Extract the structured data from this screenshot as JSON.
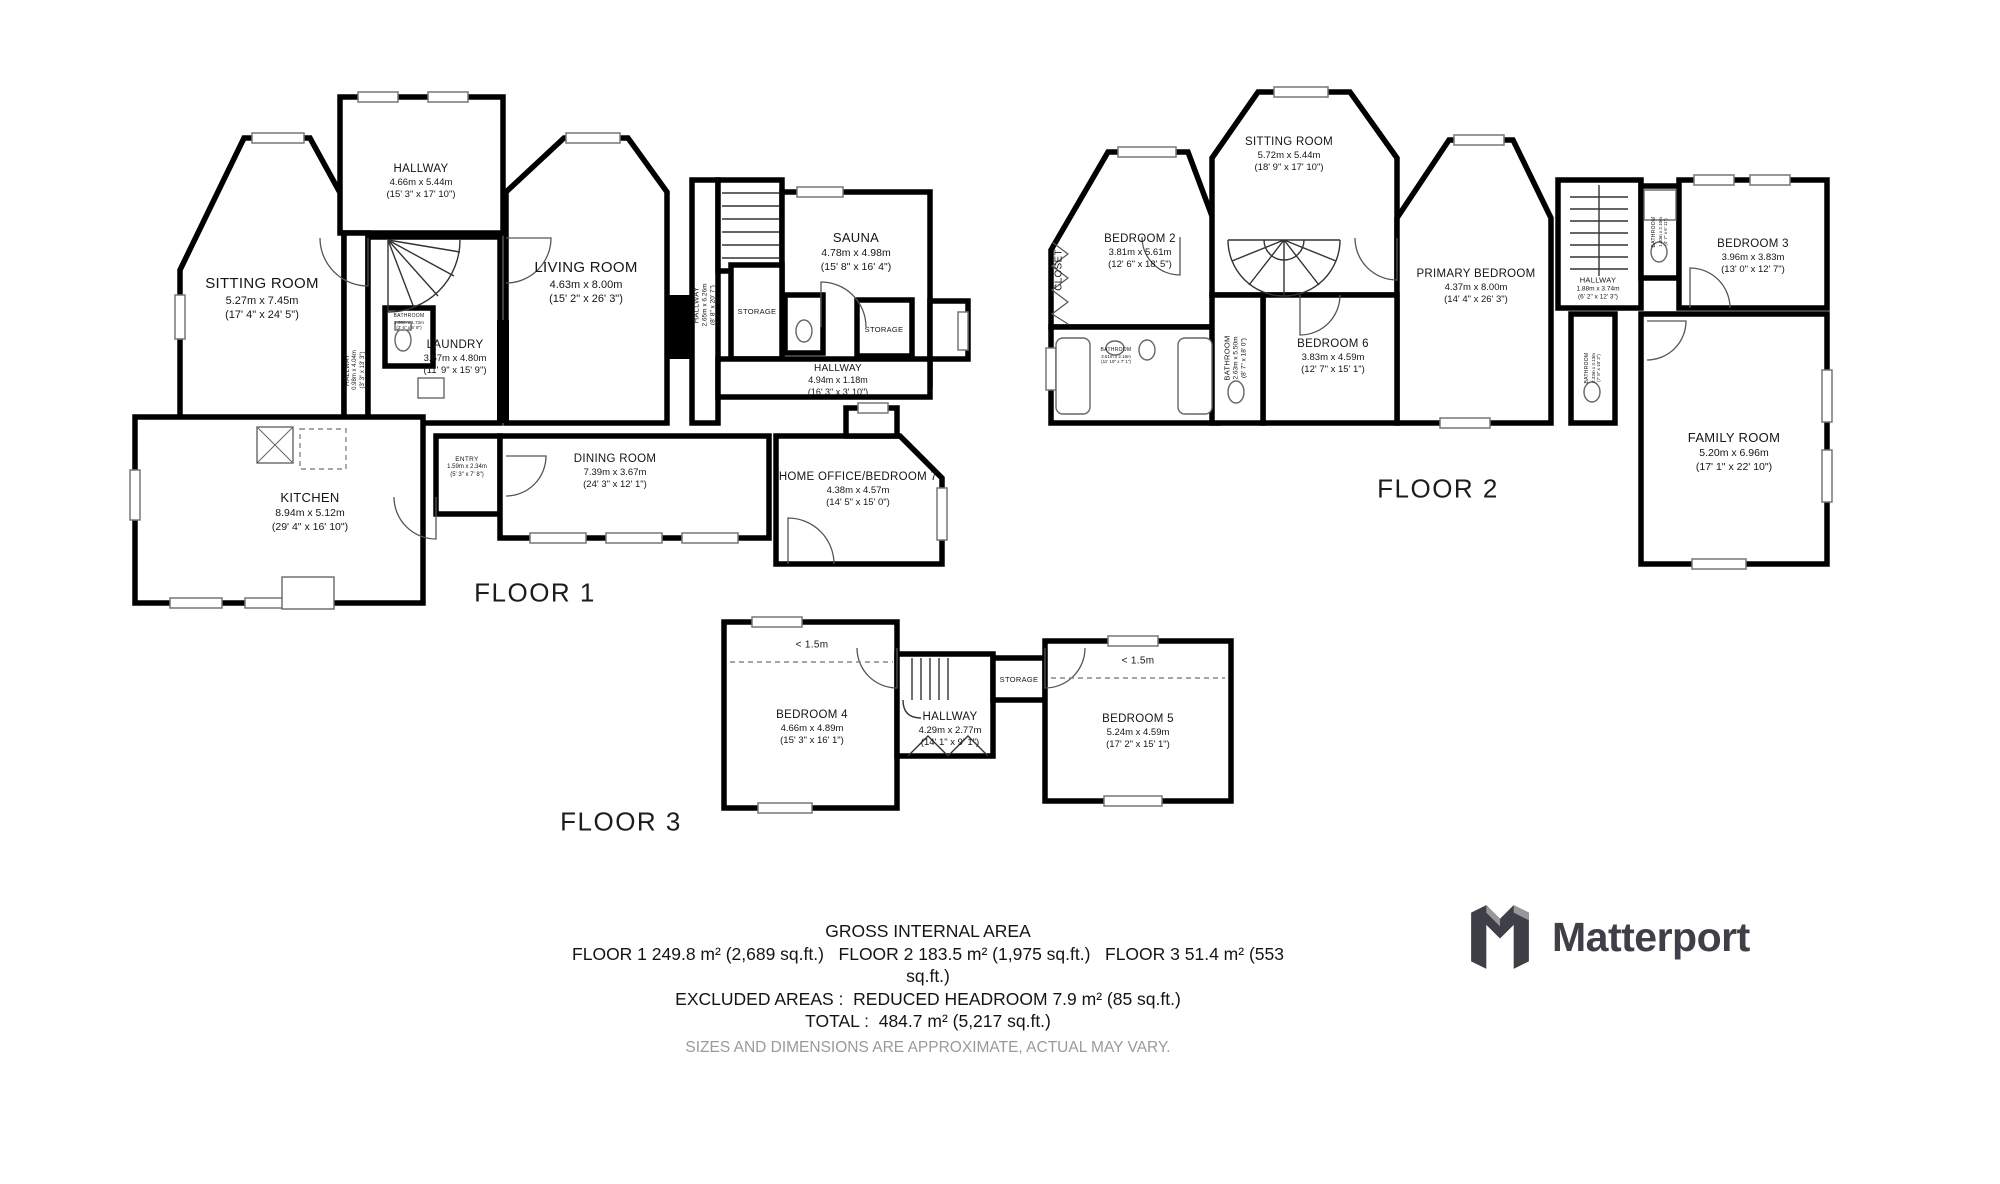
{
  "floors": [
    {
      "label": "FLOOR 1",
      "rooms": [
        {
          "name": "SITTING ROOM",
          "m": "5.27m x 7.45m",
          "ft": "(17' 4\" x 24' 5\")"
        },
        {
          "name": "HALLWAY",
          "m": "4.66m x 5.44m",
          "ft": "(15' 3\" x 17' 10\")"
        },
        {
          "name": "LIVING ROOM",
          "m": "4.63m x 8.00m",
          "ft": "(15' 2\" x 26' 3\")"
        },
        {
          "name": "LAUNDRY",
          "m": "3.57m x 4.80m",
          "ft": "(11' 9\" x 15' 9\")"
        },
        {
          "name": "HALLWAY",
          "m": "0.98m x 4.04m",
          "ft": "(3' 3\" x 13' 3\")"
        },
        {
          "name": "SAUNA",
          "m": "4.78m x 4.98m",
          "ft": "(15' 8\" x 16' 4\")"
        },
        {
          "name": "HALLWAY",
          "m": "2.65m x 6.26m",
          "ft": "(8' 8\" x 20' 7\")"
        },
        {
          "name": "STORAGE"
        },
        {
          "name": "STORAGE"
        },
        {
          "name": "HALLWAY",
          "m": "4.94m x 1.18m",
          "ft": "(16' 3\" x 3' 10\")"
        },
        {
          "name": "KITCHEN",
          "m": "8.94m x 5.12m",
          "ft": "(29' 4\" x 16' 10\")"
        },
        {
          "name": "ENTRY",
          "m": "1.59m x 2.34m",
          "ft": "(5' 3\" x 7' 8\")"
        },
        {
          "name": "DINING ROOM",
          "m": "7.39m x 3.67m",
          "ft": "(24' 3\" x 12' 1\")"
        },
        {
          "name": "HOME OFFICE/BEDROOM 7",
          "m": "4.38m x 4.57m",
          "ft": "(14' 5\" x 15' 0\")"
        },
        {
          "name": "BATHROOM",
          "m": "1.06m x 1.72m",
          "ft": "(3' 6\" x 5' 8\")"
        }
      ]
    },
    {
      "label": "FLOOR 2",
      "rooms": [
        {
          "name": "BEDROOM 2",
          "m": "3.81m x 5.61m",
          "ft": "(12' 6\" x 18' 5\")"
        },
        {
          "name": "SITTING ROOM",
          "m": "5.72m x 5.44m",
          "ft": "(18' 9\" x 17' 10\")"
        },
        {
          "name": "PRIMARY BEDROOM",
          "m": "4.37m x 8.00m",
          "ft": "(14' 4\" x 26' 3\")"
        },
        {
          "name": "BEDROOM 6",
          "m": "3.83m x 4.59m",
          "ft": "(12' 7\" x 15' 1\")"
        },
        {
          "name": "BATHROOM",
          "m": "2.63m x 5.50m",
          "ft": "(8' 7\" x 18' 0\")"
        },
        {
          "name": "CLOSET"
        },
        {
          "name": "BATHROOM",
          "m": "3.61m x 2.16m",
          "ft": "(11' 10\" x 7' 1\")"
        },
        {
          "name": "HALLWAY",
          "m": "1.88m x 3.74m",
          "ft": "(6' 2\" x 12' 3\")"
        },
        {
          "name": "BEDROOM 3",
          "m": "3.96m x 3.83m",
          "ft": "(13' 0\" x 12' 7\")"
        },
        {
          "name": "BATHROOM",
          "m": "2.33m x 3.13m",
          "ft": "(7' 8\" x 10' 3\")"
        },
        {
          "name": "FAMILY ROOM",
          "m": "5.20m x 6.96m",
          "ft": "(17' 1\" x 22' 10\")"
        },
        {
          "name": "BATHROOM",
          "m": "1.40m x 2.10m",
          "ft": "(4' 7\" x 6' 11\")"
        }
      ]
    },
    {
      "label": "FLOOR 3",
      "rooms": [
        {
          "name": "BEDROOM 4",
          "m": "4.66m x 4.89m",
          "ft": "(15' 3\" x 16' 1\")"
        },
        {
          "name": "HALLWAY",
          "m": "4.29m x 2.77m",
          "ft": "(14' 1\" x 9' 1\")"
        },
        {
          "name": "BEDROOM 5",
          "m": "5.24m x 4.59m",
          "ft": "(17' 2\" x 15' 1\")"
        },
        {
          "name": "STORAGE"
        },
        {
          "name": "< 1.5m"
        },
        {
          "name": "< 1.5m"
        }
      ]
    }
  ],
  "footer": {
    "line1": "GROSS INTERNAL AREA",
    "line2a": "FLOOR 1 249.8 m² (2,689 sq.ft.)   FLOOR 2 183.5 m² (1,975 sq.ft.)   FLOOR 3 51.4 m² (553",
    "line2b": "sq.ft.)",
    "line3": "EXCLUDED AREAS :  REDUCED HEADROOM 7.9 m² (85 sq.ft.)",
    "line4": "TOTAL :  484.7 m² (5,217 sq.ft.)",
    "line5": "SIZES AND DIMENSIONS ARE APPROXIMATE, ACTUAL MAY VARY."
  },
  "brand": {
    "name": "Matterport"
  },
  "colors": {
    "wall": "#000000",
    "muted": "#9a9a9a",
    "logo": "#3f3f47"
  }
}
